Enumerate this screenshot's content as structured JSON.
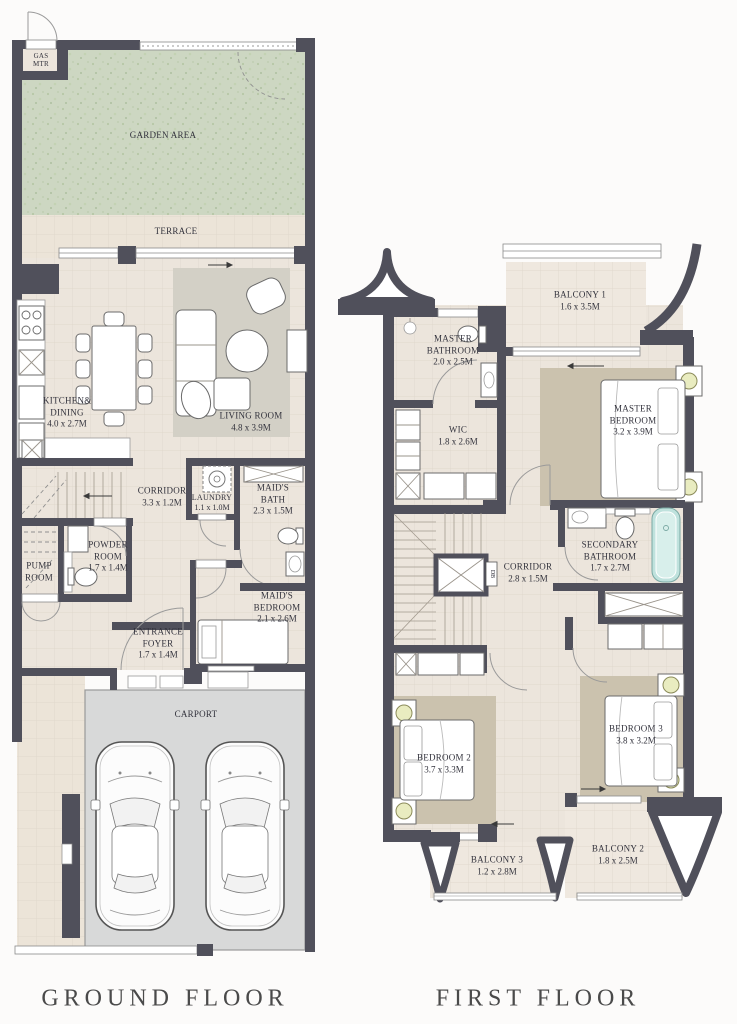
{
  "captions": {
    "ground": "GROUND FLOOR",
    "first": "FIRST FLOOR"
  },
  "ground_floor": {
    "rooms": {
      "gas_meter": {
        "name": "GAS MTR"
      },
      "garden": {
        "name": "GARDEN AREA"
      },
      "terrace": {
        "name": "TERRACE"
      },
      "kitchen_dining": {
        "name": "KITCHEN& DINING",
        "dims": "4.0 x 2.7M"
      },
      "living_room": {
        "name": "LIVING ROOM",
        "dims": "4.8 x 3.9M"
      },
      "corridor": {
        "name": "CORRIDOR",
        "dims": "3.3 x 1.2M"
      },
      "laundry": {
        "name": "LAUNDRY",
        "dims": "1.1 x 1.0M"
      },
      "maids_bath": {
        "name": "MAID'S BATH",
        "dims": "2.3 x 1.5M"
      },
      "pump_room": {
        "name": "PUMP ROOM"
      },
      "powder_room": {
        "name": "POWDER ROOM",
        "dims": "1.7 x 1.4M"
      },
      "maids_bedroom": {
        "name": "MAID'S BEDROOM",
        "dims": "2.1 x 2.6M"
      },
      "entrance_foyer": {
        "name": "ENTRANCE FOYER",
        "dims": "1.7 x 1.4M"
      },
      "carport": {
        "name": "CARPORT"
      }
    }
  },
  "first_floor": {
    "rooms": {
      "balcony1": {
        "name": "BALCONY 1",
        "dims": "1.6 x 3.5M"
      },
      "master_bathroom": {
        "name": "MASTER BATHROOM",
        "dims": "2.0 x 2.5M"
      },
      "wic": {
        "name": "WIC",
        "dims": "1.8 x 2.6M"
      },
      "master_bedroom": {
        "name": "MASTER BEDROOM",
        "dims": "3.2 x 3.9M"
      },
      "corridor": {
        "name": "CORRIDOR",
        "dims": "2.8 x 1.5M"
      },
      "secondary_bathroom": {
        "name": "SECONDARY BATHROOM",
        "dims": "1.7 x 2.7M"
      },
      "bedroom2": {
        "name": "BEDROOM 2",
        "dims": "3.7 x 3.3M"
      },
      "bedroom3": {
        "name": "BEDROOM 3",
        "dims": "3.8 x 3.2M"
      },
      "balcony3": {
        "name": "BALCONY 3",
        "dims": "1.2 x 2.8M"
      },
      "balcony2": {
        "name": "BALCONY 2",
        "dims": "1.8 x 2.5M"
      }
    },
    "db_label": "DB"
  },
  "colors": {
    "wall": "#50505b",
    "floor": "#ece5dc",
    "garden": "#cdd7c2",
    "carport": "#d8d9d9",
    "living_rug": "#d3d0c6",
    "bedroom_rug": "#cbc2ae",
    "bathtub": "#bfe2dd",
    "lamp": "#e9ecc0"
  }
}
